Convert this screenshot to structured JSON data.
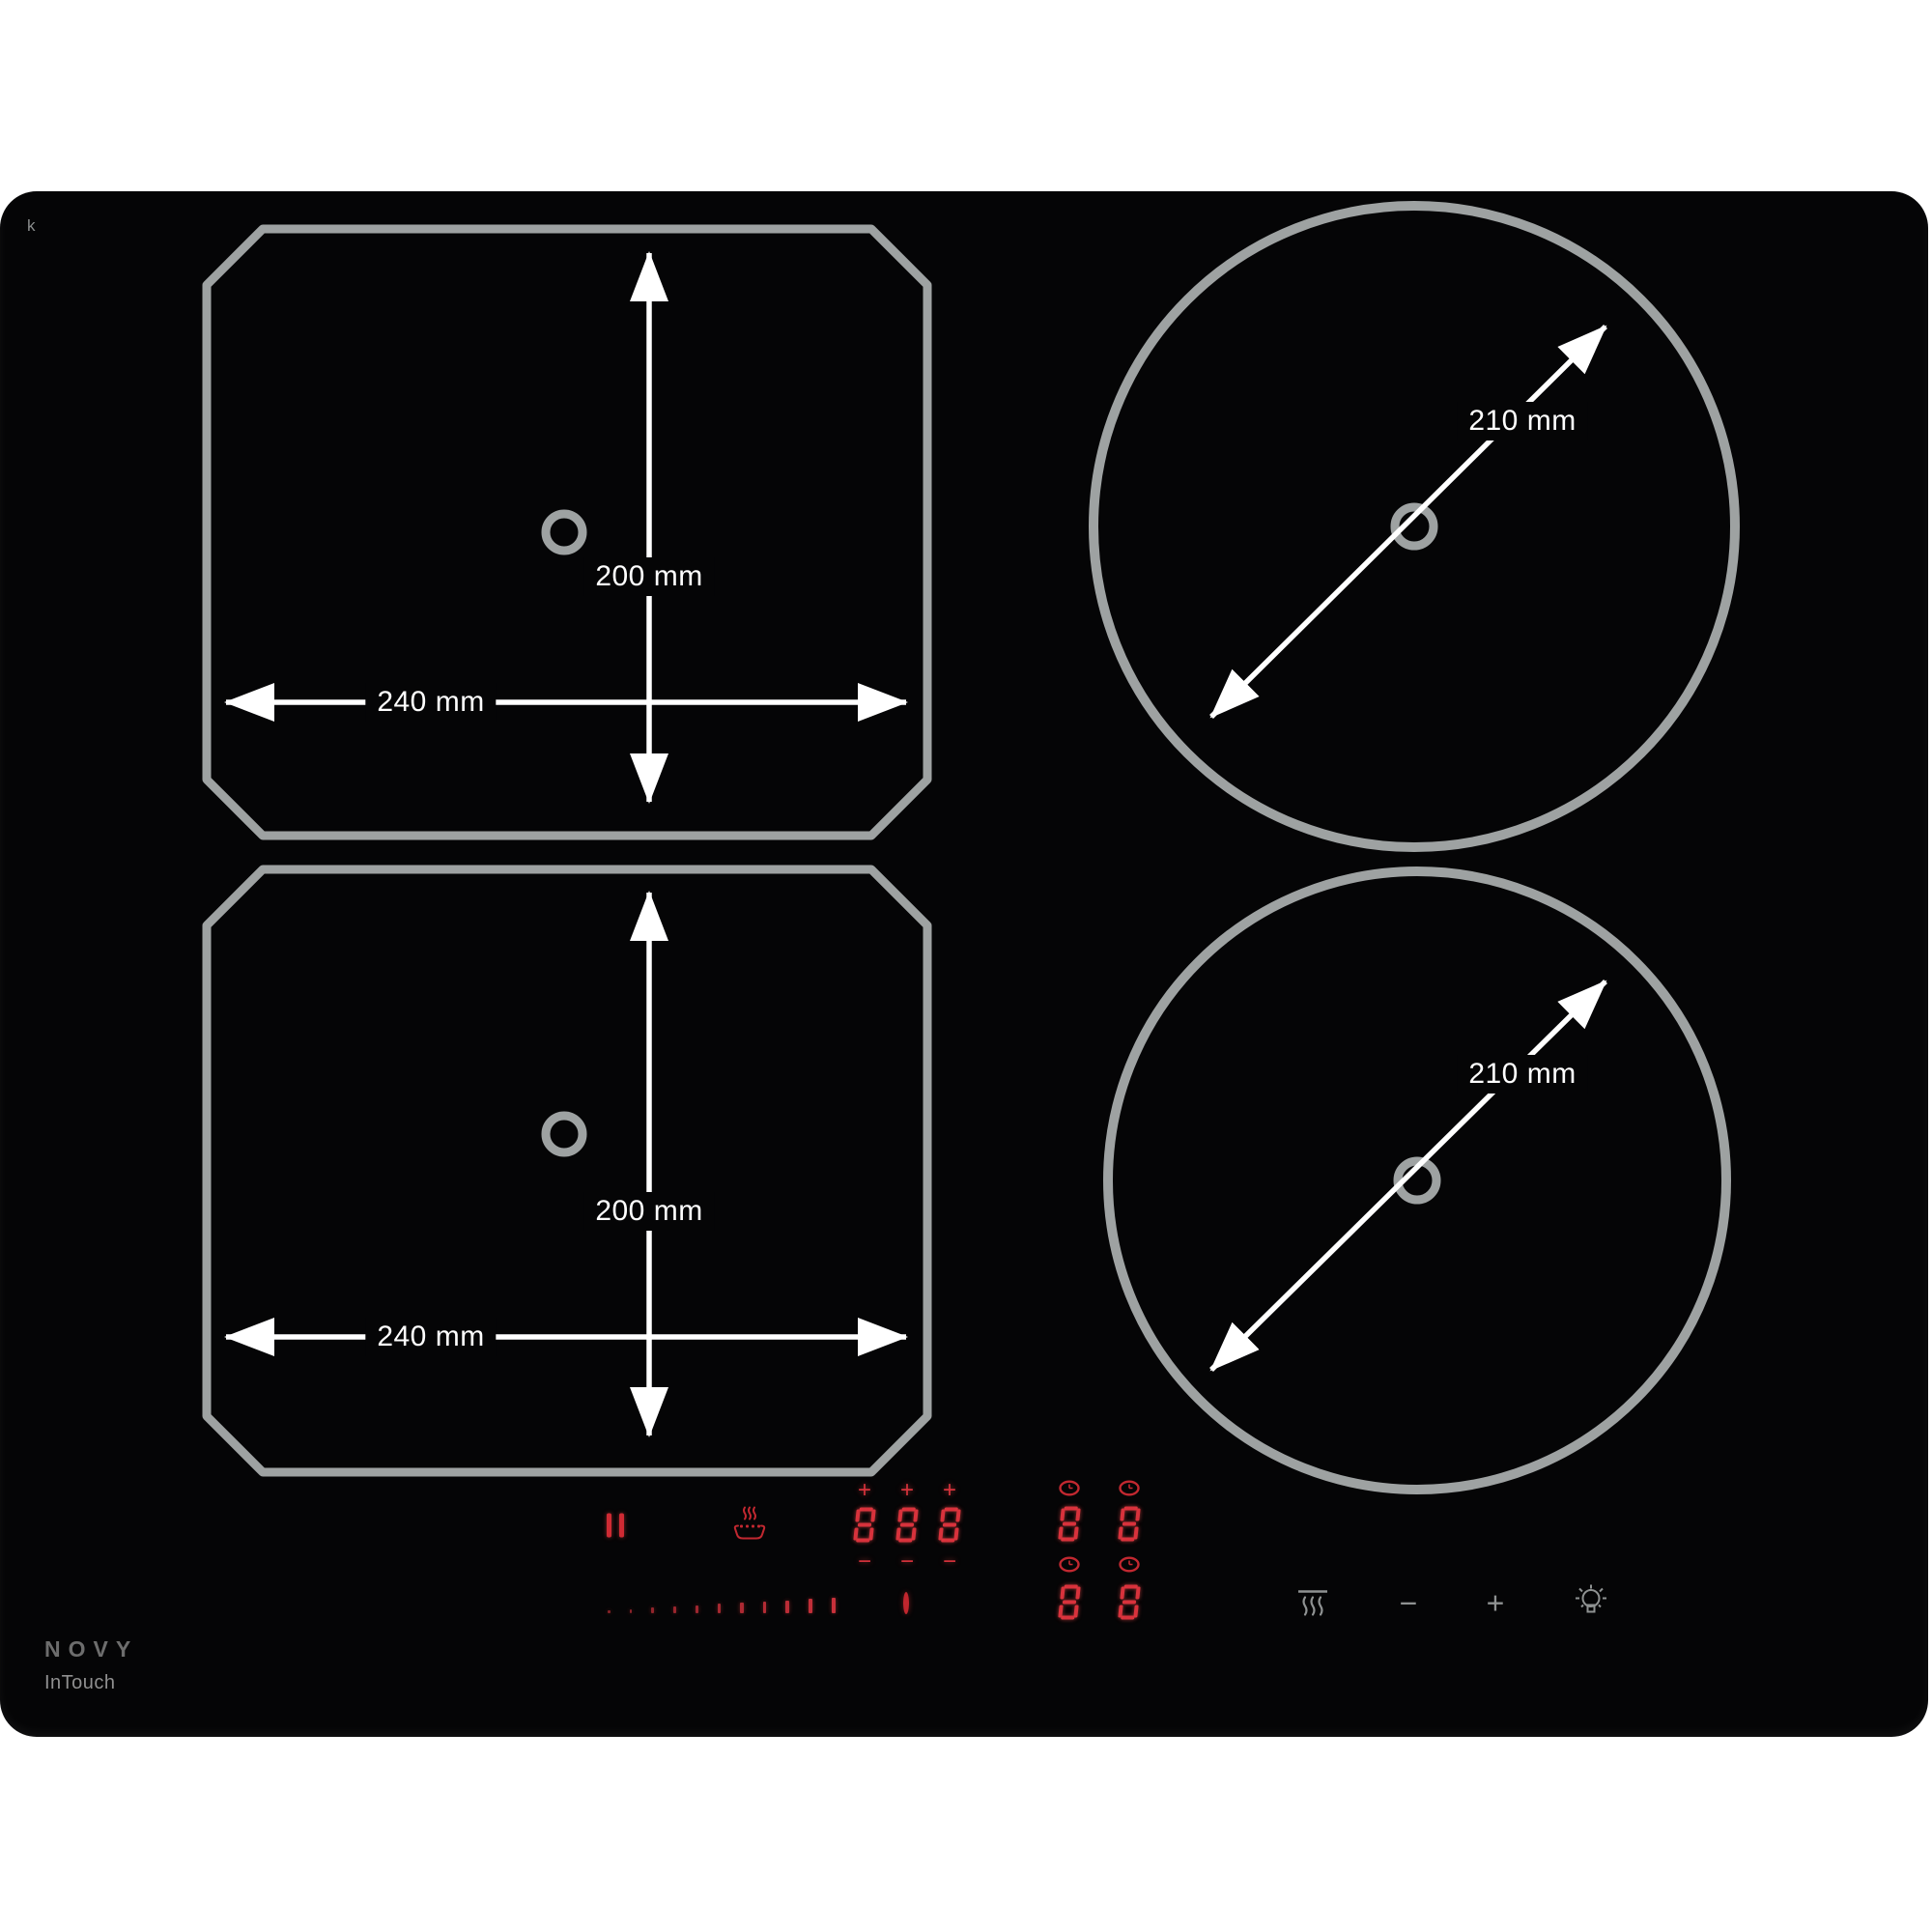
{
  "product": {
    "brand": "NOVY",
    "line": "InTouch",
    "watermark": "k"
  },
  "zones": {
    "flex_top_left": {
      "width_label": "240 mm",
      "height_label": "200 mm"
    },
    "flex_bottom_left": {
      "width_label": "240 mm",
      "height_label": "200 mm"
    },
    "round_top_right": {
      "diameter_label": "210 mm"
    },
    "round_bottom_right": {
      "diameter_label": "210 mm"
    }
  },
  "controls": {
    "pause_icon": "pause",
    "keep_warm_icon": "keep-warm",
    "left_display": {
      "plus": "+",
      "minus": "−",
      "digits": [
        "8",
        "8",
        "8"
      ]
    },
    "timer_display": {
      "clock_icon": "timer",
      "top_digits": [
        "8",
        "8"
      ],
      "bottom_digits": [
        "8",
        "8"
      ]
    },
    "slider": {
      "tick_count": 11
    },
    "power_icon": "standby",
    "hood": {
      "vent_icon": "extraction",
      "minus": "−",
      "plus": "+",
      "light_icon": "light"
    }
  },
  "colors": {
    "panel": "#050506",
    "zone_outline": "#9ea2a2",
    "arrow": "#ffffff",
    "display_red": "#d5323b",
    "control_gray": "#8f9292"
  }
}
